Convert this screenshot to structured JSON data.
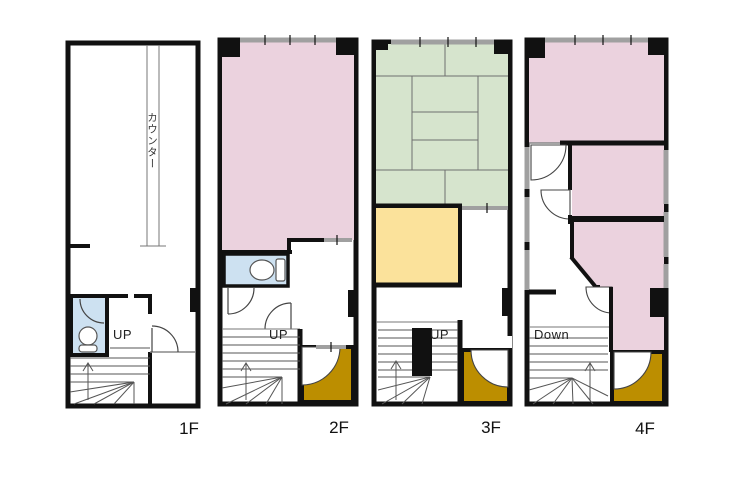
{
  "colors": {
    "wall": "#111111",
    "window": "#a0a0a0",
    "room_pink": "#ebd2de",
    "tatami_green": "#d6e4cd",
    "room_yellow": "#fbe29b",
    "storage_gold": "#bc8e00",
    "toilet_blue": "#cde1f1"
  },
  "floors": [
    {
      "label": "1F",
      "annotations": {
        "counter": "カウンター",
        "stair_direction": "UP"
      },
      "features": [
        "counter",
        "toilet",
        "winder-stairs",
        "door"
      ]
    },
    {
      "label": "2F",
      "annotations": {
        "stair_direction": "UP"
      },
      "features": [
        "main-room",
        "toilet",
        "winder-stairs",
        "storage-room",
        "windows"
      ]
    },
    {
      "label": "3F",
      "annotations": {
        "stair_direction": "UP"
      },
      "features": [
        "tatami-room",
        "inner-room",
        "winder-stairs",
        "storage-room",
        "windows"
      ]
    },
    {
      "label": "4F",
      "annotations": {
        "stair_direction": "Down"
      },
      "features": [
        "main-room",
        "middle-room",
        "lower-room",
        "corridor",
        "winder-stairs",
        "storage-room",
        "windows"
      ]
    }
  ]
}
